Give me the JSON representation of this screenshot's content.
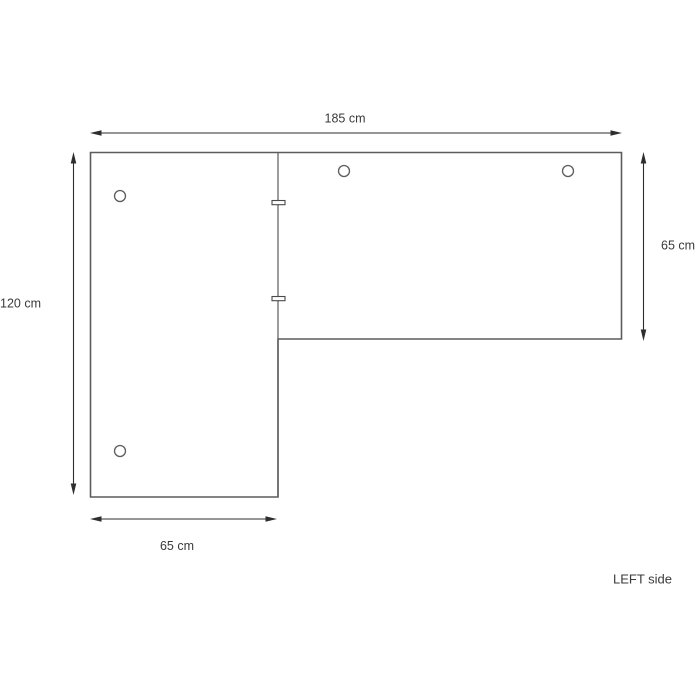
{
  "diagram": {
    "kind": "furniture-assembly-drawing",
    "caption": "LEFT side",
    "unit": "cm",
    "desk": {
      "shape": "L-shaped desk top, plan view",
      "total_width_cm": 185,
      "left_panel": {
        "width_cm": 65,
        "depth_cm": 120
      },
      "right_panel": {
        "depth_cm": 65
      }
    },
    "dimensions": {
      "top_width_label": "185 cm",
      "right_depth_label": "65 cm",
      "left_depth_label": "120 cm",
      "bottom_width_label": "65 cm"
    },
    "holes": [
      {
        "cx": 120,
        "cy": 196,
        "r": 5.5
      },
      {
        "cx": 120,
        "cy": 451,
        "r": 5.5
      },
      {
        "cx": 344,
        "cy": 171,
        "r": 5.5
      },
      {
        "cx": 568,
        "cy": 171,
        "r": 5.5
      }
    ],
    "connectors": [
      {
        "x": 272,
        "y": 200.5,
        "w": 13,
        "h": 4.2
      },
      {
        "x": 272,
        "y": 296.5,
        "w": 13,
        "h": 4.2
      }
    ],
    "colors": {
      "outline": "#5c5c5c",
      "dimension": "#2e2e2e",
      "text": "#3a3a3a",
      "background": "#ffffff"
    }
  }
}
